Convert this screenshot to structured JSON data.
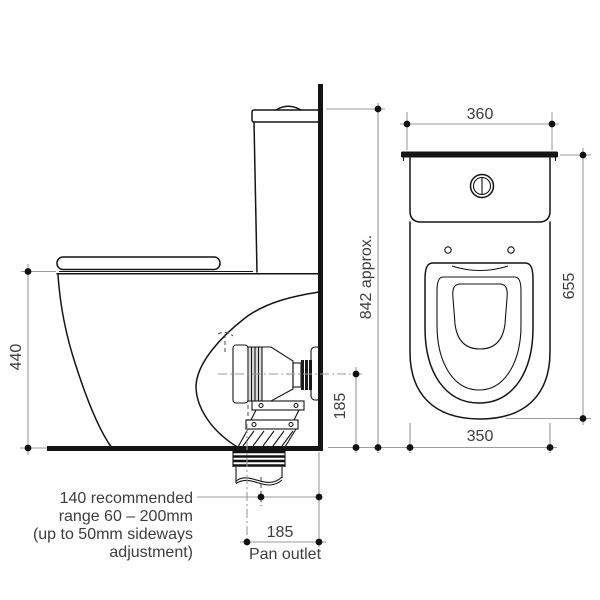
{
  "diagram": {
    "side_view": {
      "seat_height": "440",
      "overall_height": "842 approx.",
      "outlet_centre_height": "185",
      "outlet_note": {
        "line1": "140 recommended",
        "line2": "range 60 – 200mm",
        "line3": "(up to 50mm sideways",
        "line4": "adjustment)"
      },
      "pan_outlet": {
        "dimension": "185",
        "label": "Pan outlet"
      }
    },
    "front_view": {
      "cistern_width": "360",
      "overall_depth": "655",
      "pan_width": "350"
    },
    "colors": {
      "outline": "#141414",
      "dimension_line": "#9b9b9b",
      "text": "#3d3d3d",
      "background": "#ffffff"
    }
  }
}
